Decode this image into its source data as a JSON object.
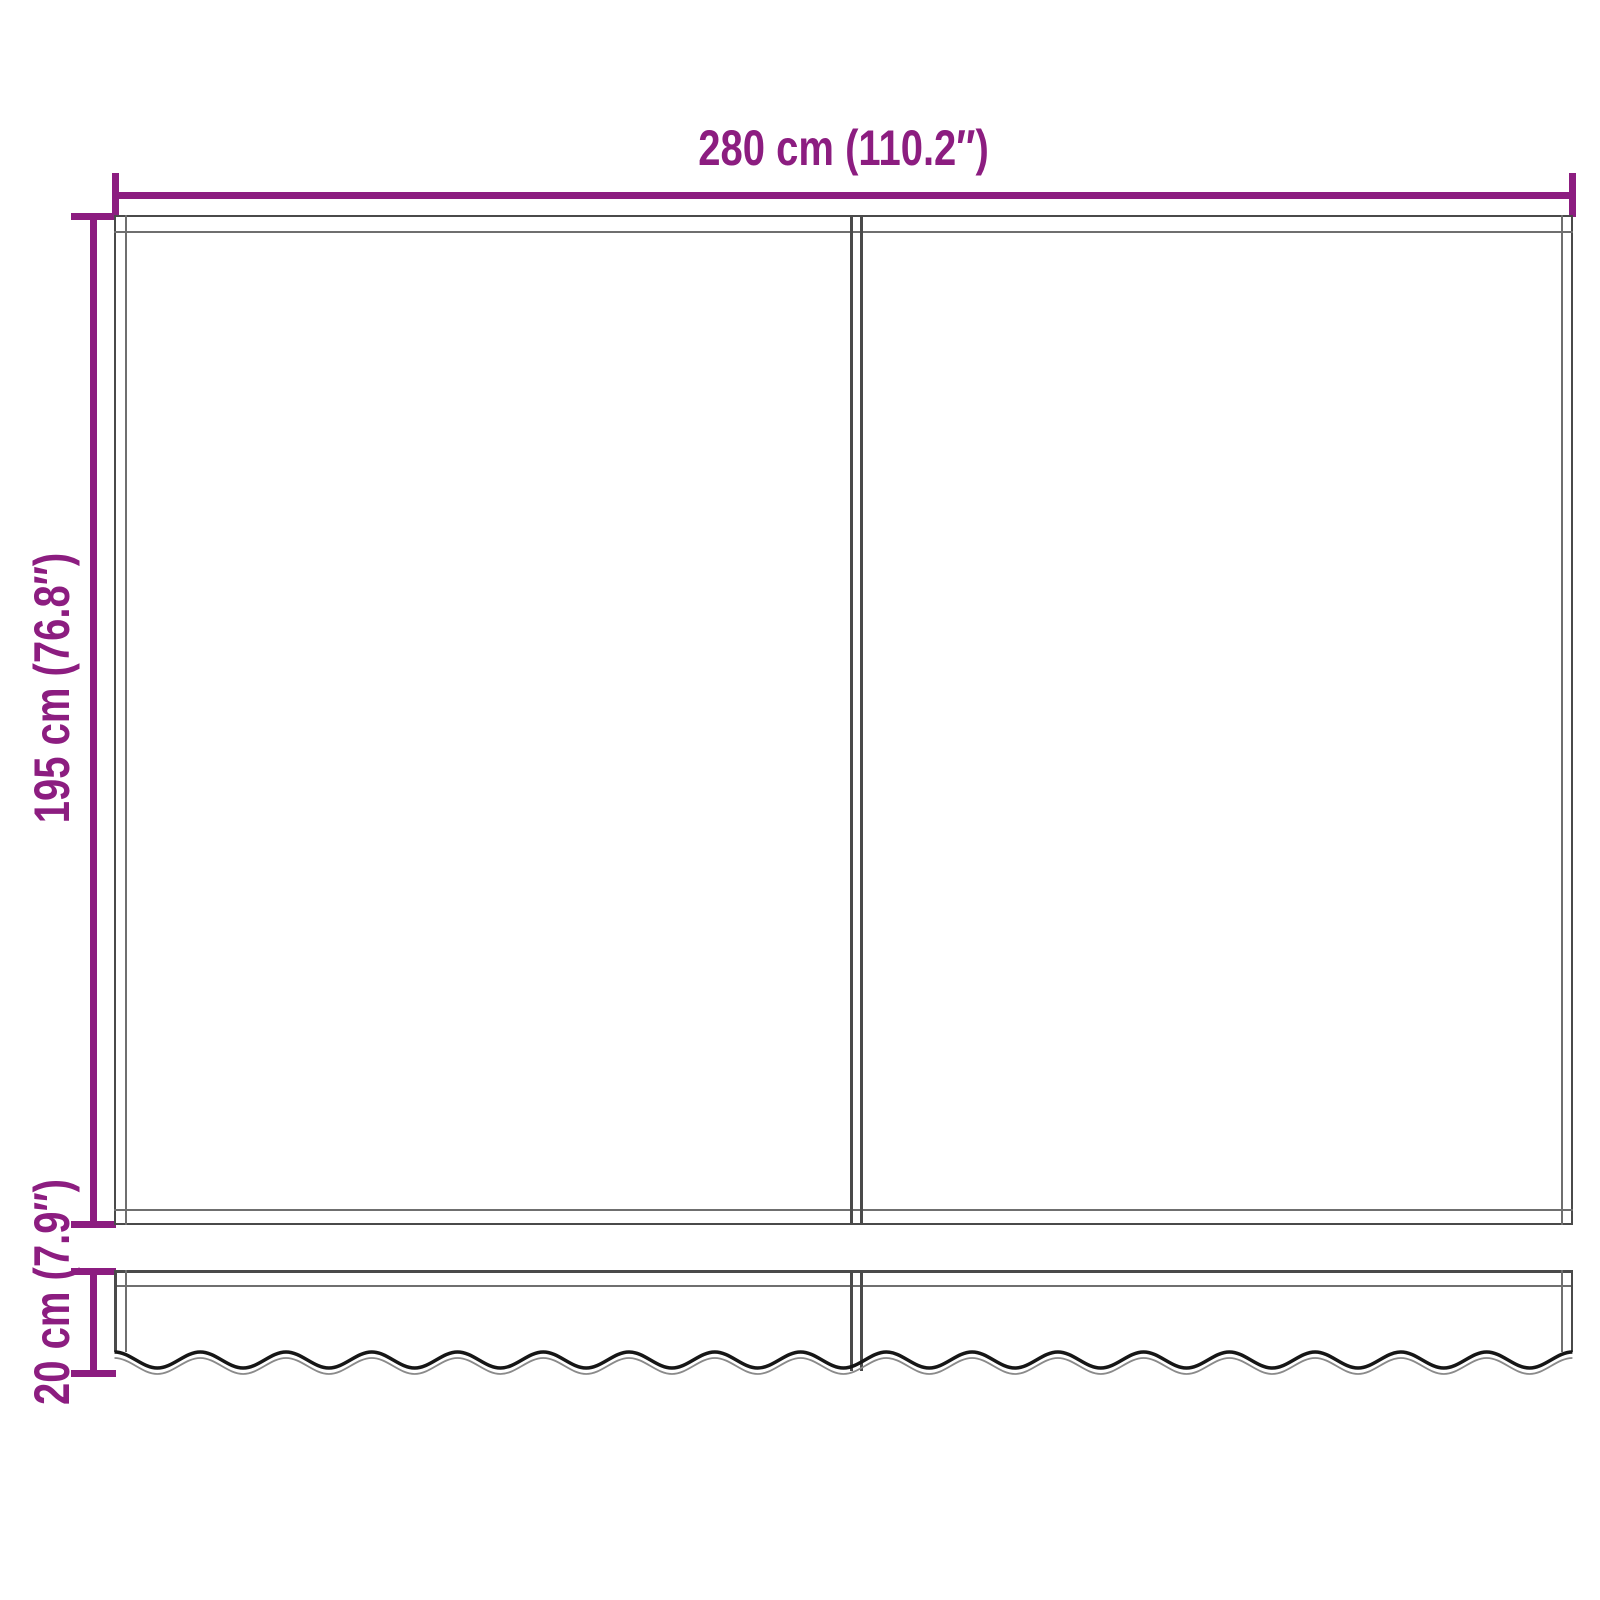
{
  "labels": {
    "width": "280 cm (110.2″)",
    "height": "195 cm (76.8″)",
    "valance_height": "20 cm (7.9″)"
  },
  "colors": {
    "dimension": "#8C1D80",
    "outline_dark": "#4A4A4A",
    "outline_light": "#6F6F6F",
    "wave_dark": "#161616",
    "wave_light": "#8A8A8A",
    "background": "#FFFFFF"
  }
}
